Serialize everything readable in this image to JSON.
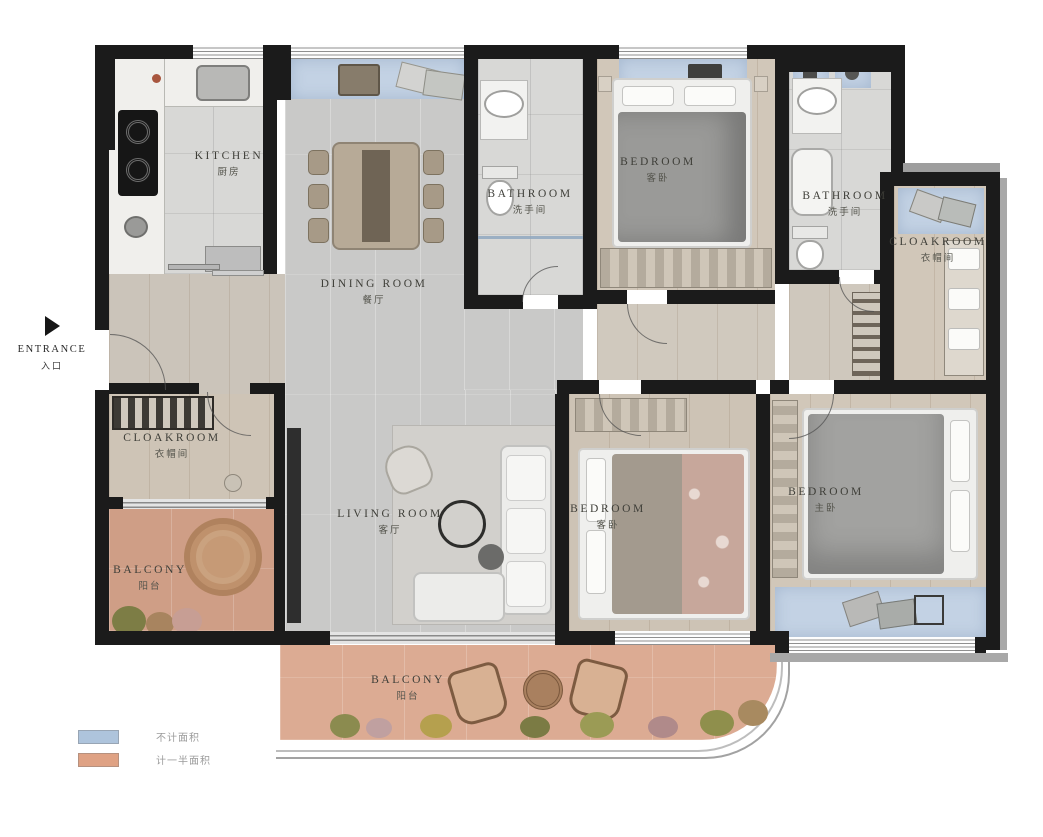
{
  "colors": {
    "wall": "#1b1b1b",
    "floor_gray": "#c9c9c8",
    "floor_wood": "#d1c7b9",
    "floor_tile": "#d8d8d6",
    "balcony_pink": "#d5a48c",
    "window_blue": "#c3d2e4",
    "trim_gray": "#a8a8a8",
    "label_text": "#3e3e38"
  },
  "entrance": {
    "label": "ENTRANCE",
    "sublabel": "入口"
  },
  "legend": [
    {
      "swatch": "#aec4dc",
      "label": "不计面积"
    },
    {
      "swatch": "#dfa284",
      "label": "计一半面积"
    }
  ],
  "rooms": {
    "kitchen": {
      "label": "KITCHEN",
      "sublabel": "厨房"
    },
    "dining": {
      "label": "DINING ROOM",
      "sublabel": "餐厅"
    },
    "bathroom1": {
      "label": "BATHROOM",
      "sublabel": "洗手间"
    },
    "bedroom_top": {
      "label": "BEDROOM",
      "sublabel": "客卧"
    },
    "bathroom2": {
      "label": "BATHROOM",
      "sublabel": "洗手间"
    },
    "cloakroom_right": {
      "label": "CLOAKROOM",
      "sublabel": "衣帽间"
    },
    "cloakroom_left": {
      "label": "CLOAKROOM",
      "sublabel": "衣帽间"
    },
    "living": {
      "label": "LIVING ROOM",
      "sublabel": "客厅"
    },
    "bedroom_middle": {
      "label": "BEDROOM",
      "sublabel": "客卧"
    },
    "bedroom_master": {
      "label": "BEDROOM",
      "sublabel": "主卧"
    },
    "balcony_left": {
      "label": "BALCONY",
      "sublabel": "阳台"
    },
    "balcony_bottom": {
      "label": "BALCONY",
      "sublabel": "阳台"
    }
  }
}
